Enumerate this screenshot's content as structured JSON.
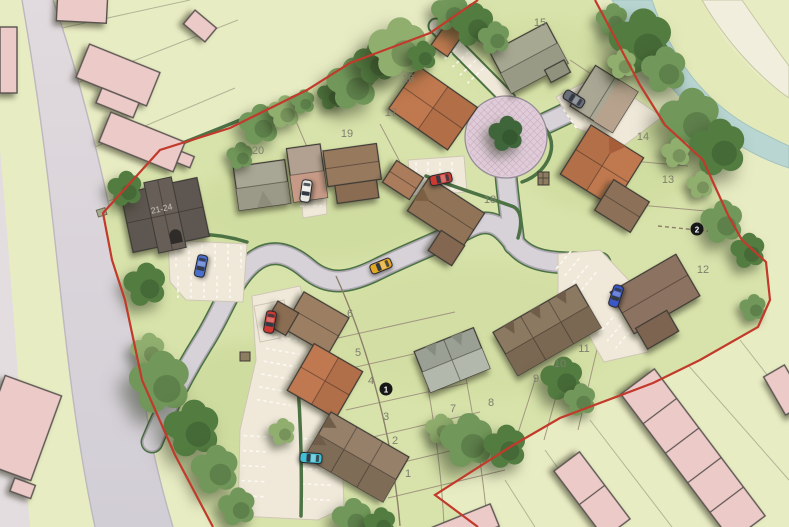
{
  "plan": {
    "type": "residential development site plan",
    "boundary_color": "#c13a2b",
    "plot_labels": {
      "p1": "1",
      "p2": "2",
      "p3": "3",
      "p4": "4",
      "p5": "5",
      "p6": "6",
      "p7": "7",
      "p8": "8",
      "p9": "9",
      "p10": "10",
      "p11": "11",
      "p12": "12",
      "p13": "13",
      "p14": "14",
      "p15": "15",
      "p16": "16",
      "p17": "17",
      "p18": "18",
      "p19": "19",
      "p20": "20"
    },
    "apartment_block_label": "21-24",
    "markers": {
      "m1": "1",
      "m2": "2"
    },
    "colors": {
      "fields": "#e8ecc3",
      "site_grass": "#d8e3ab",
      "road": "#d6d2d8",
      "road_hedge": "#4b7243",
      "driveway": "#f0e9da",
      "roundabout": "#dfccd8",
      "stream": "#b9d6d2",
      "existing_building": "#eccac8",
      "car_red": "#cc3a31",
      "car_blue": "#4a6ecb",
      "car_yellow": "#e3a722",
      "car_teal": "#3fc0d4",
      "car_white": "#e9e9e3",
      "car_grey": "#6a6e76"
    }
  }
}
